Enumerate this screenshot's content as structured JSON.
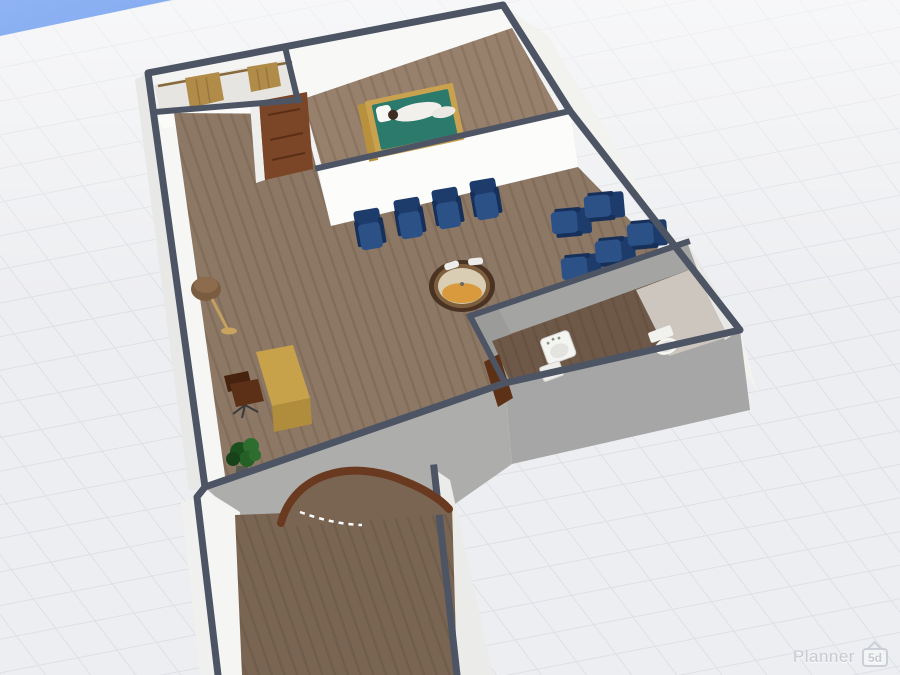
{
  "app": {
    "name": "Planner 5D",
    "watermark": {
      "text": "Planner",
      "badge": "5d"
    }
  },
  "colors": {
    "sky": "#7fa7ef",
    "ground": "#edeef1",
    "grid-line": "#dde0e5",
    "wall-edge": "#4d5564",
    "floor-main": "#8d7765",
    "floor-bedroom": "#97816c",
    "floor-corridor": "#7a6553",
    "floor-bath": "#6e5948",
    "chair-back": "#1e3c6b",
    "chair-seat": "#2c5187",
    "chair-arm": "#16305a",
    "bed-frame": "#c9a250",
    "mattress": "#2c7a6b",
    "curtain": "#b08c48",
    "door": "#7b4527",
    "arch": "#6a3a20",
    "table-ring": "#4a3322",
    "table-top": "#d9ceb4",
    "table-amber": "#d89a3c",
    "desk": "#c7a24b",
    "office-chair": "#5c2f17",
    "plant": "#2d6e2f",
    "lamp": "#7a5c41",
    "watermark": "#c6cad0"
  },
  "scene": {
    "view": "3d-floor-plan",
    "rooms": [
      "closet",
      "bedroom",
      "living-room",
      "waiting-area",
      "bathroom",
      "hallway"
    ],
    "furniture_counts": {
      "armchairs": 9,
      "bed": 1,
      "person-on-bed": 1,
      "curtains": 2,
      "doors": 3,
      "round-table": 1,
      "floor-lamp": 1,
      "desk": 1,
      "office-chair": 1,
      "potted-plant": 1,
      "sink": 1,
      "toilet": 1
    }
  }
}
